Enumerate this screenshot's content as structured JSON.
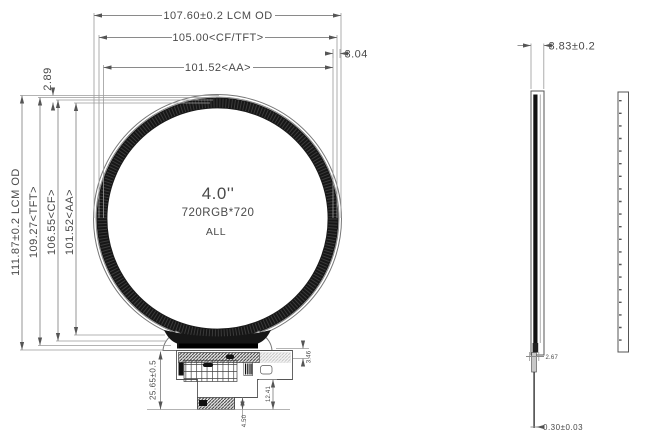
{
  "front_view": {
    "display_size": "4.0''",
    "resolution": "720RGB*720",
    "note": "ALL",
    "dim_width_od": "107.60±0.2 LCM OD",
    "dim_width_cf_tft": "105.00<CF/TFT>",
    "dim_width_aa": "101.52<AA>",
    "dim_right_gap": "3.04",
    "dim_left_gap": "2.89",
    "dim_height_od": "111.87±0.2 LCM OD",
    "dim_height_tft": "109.27<TFT>",
    "dim_height_cf": "106.55<CF>",
    "dim_height_aa": "101.52<AA>",
    "dim_fpc_length": "25.65±0.5",
    "dim_tab": "3.46",
    "dim_tail": "12.41",
    "dim_connector": "4.50"
  },
  "side_view": {
    "dim_thickness": "3.83±0.2",
    "dim_step": "2.67",
    "dim_fpc_thickness": "0.30±0.03"
  },
  "colors": {
    "background": "#ffffff",
    "dimension_line": "#8a8a8a",
    "edge_line": "#555555",
    "bezel_dark": "#161616",
    "text": "#4a4a4a"
  }
}
